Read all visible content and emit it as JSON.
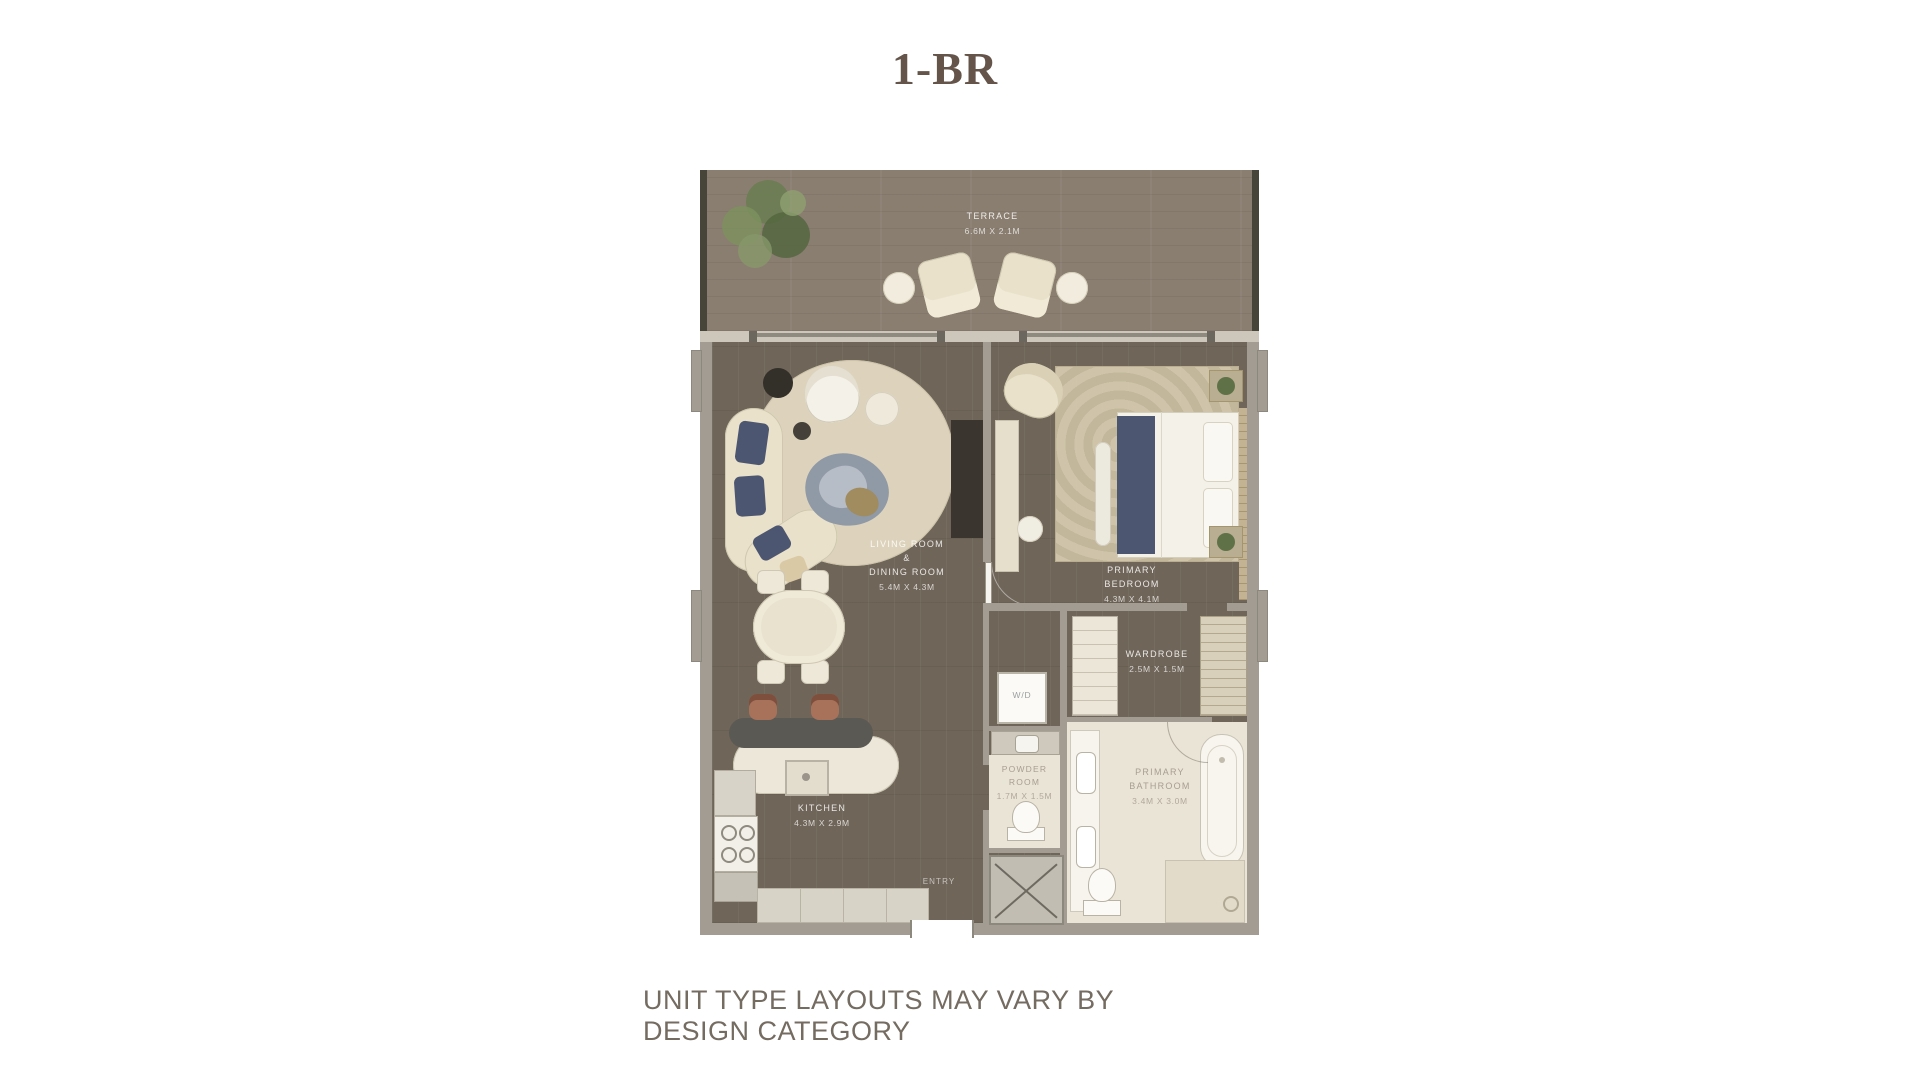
{
  "title": "1-BR",
  "disclaimer": "UNIT TYPE LAYOUTS MAY VARY BY DESIGN CATEGORY",
  "colors": {
    "title_text": "#64544a",
    "disclaimer_text": "#746b61",
    "wall": "#a29c92",
    "interior_wood": "#6f6559",
    "terrace_wood": "#8a7e70",
    "bathroom_tile": "#eae4d7",
    "furniture_cream": "#e9e1ca",
    "accent_navy": "#4d5671",
    "island_dark": "#5b5953",
    "stool_terracotta": "#a8715a",
    "plant_green": "#6a7d52"
  },
  "rooms": {
    "terrace": {
      "name": "TERRACE",
      "dims": "6.6M X 2.1M"
    },
    "living": {
      "name": "LIVING ROOM\n&\nDINING ROOM",
      "dims": "5.4M X 4.3M"
    },
    "bedroom": {
      "name": "PRIMARY\nBEDROOM",
      "dims": "4.3M X 4.1M"
    },
    "wardrobe": {
      "name": "WARDROBE",
      "dims": "2.5M X 1.5M"
    },
    "powder": {
      "name": "POWDER\nROOM",
      "dims": "1.7M X 1.5M"
    },
    "bathroom": {
      "name": "PRIMARY\nBATHROOM",
      "dims": "3.4M X 3.0M"
    },
    "kitchen": {
      "name": "KITCHEN",
      "dims": "4.3M X 2.9M"
    },
    "laundry": {
      "label": "W/D"
    },
    "entry": {
      "label": "ENTRY"
    }
  }
}
